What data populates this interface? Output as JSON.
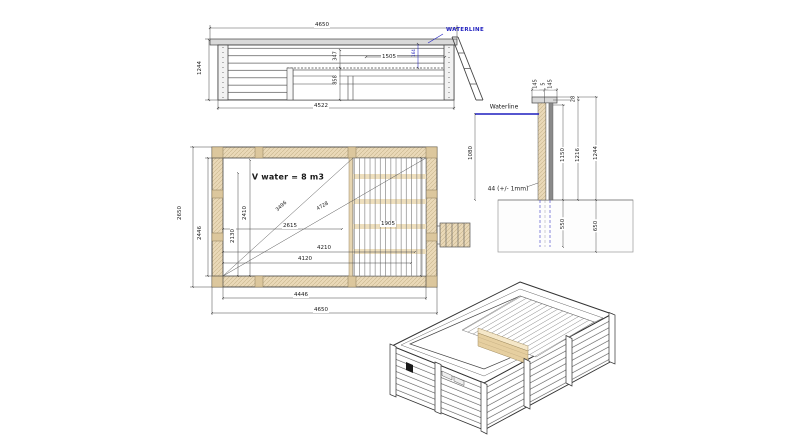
{
  "elevation": {
    "width_top": "4650",
    "width_bottom": "4522",
    "height_left": "1244",
    "bench_width": "1505",
    "dim_347": "347",
    "dim_858": "858",
    "waterline_offset": "164",
    "waterline_label": "WATERLINE"
  },
  "plan": {
    "volume": "V water = 8 m3",
    "diag_1": "3496",
    "diag_2": "4728",
    "width_2615": "2615",
    "width_4210": "4210",
    "width_4120": "4120",
    "height_2410": "2410",
    "height_2130": "2130",
    "deck_width": "1905",
    "outer_height": "2650",
    "inner_height": "2446",
    "inner_width": "4446",
    "outer_width": "4650"
  },
  "section": {
    "waterline_label": "Waterline",
    "cap_left": "145",
    "cap_gap": "5",
    "cap_right": "145",
    "rim_offset": "28",
    "wall_1150": "1150",
    "wall_1216": "1216",
    "total_height": "1244",
    "water_depth": "1080",
    "wall_thickness": "44 (+/- 1mm)",
    "embed_550": "550",
    "footing_650": "650"
  },
  "colors": {
    "dimension_blue": "#1f1fbf",
    "wood_tan": "#ead9b8",
    "line_dark": "#444444"
  }
}
